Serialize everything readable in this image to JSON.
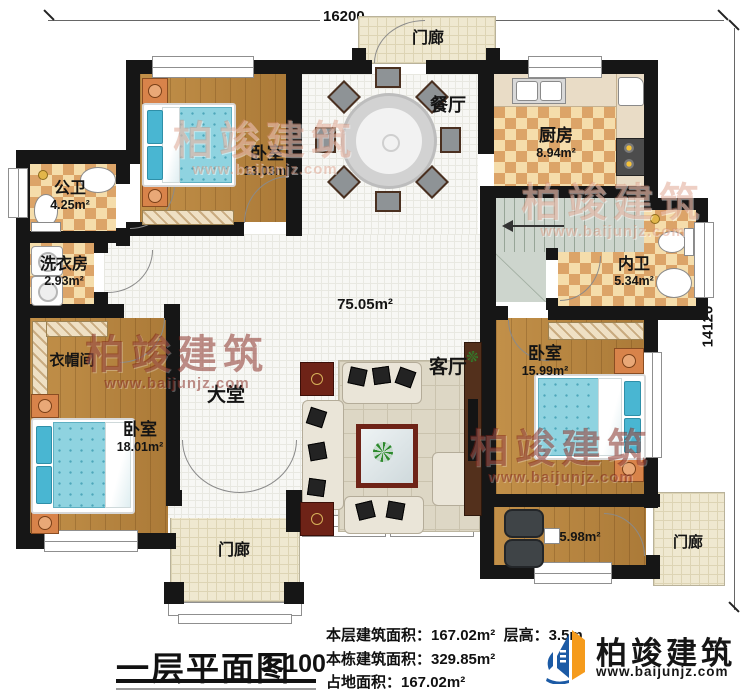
{
  "dimensions": {
    "top": "16200",
    "right": "14120"
  },
  "watermark": {
    "name": "柏竣建筑",
    "site": "www.baijunjz.com"
  },
  "rooms": {
    "porch_top": {
      "label": "门廊"
    },
    "dining": {
      "label": "餐厅"
    },
    "kitchen": {
      "label": "厨房",
      "area": "8.94m²"
    },
    "bedroom_top_left": {
      "label": "卧室",
      "area": "13.03m²"
    },
    "public_bath": {
      "label": "公卫",
      "area": "4.25m²"
    },
    "laundry": {
      "label": "洗衣房",
      "area": "2.93m²"
    },
    "cloakroom": {
      "label": "衣帽间"
    },
    "hall": {
      "label": "大堂",
      "area": "75.05m²"
    },
    "living": {
      "label": "客厅"
    },
    "ensuite_bath": {
      "label": "内卫",
      "area": "5.34m²"
    },
    "bedroom_right": {
      "label": "卧室",
      "area": "15.99m²"
    },
    "bedroom_bottom_left": {
      "label": "卧室",
      "area": "18.01m²"
    },
    "sunroom": {
      "area": "5.98m²"
    },
    "porch_bottom_left": {
      "label": "门廊"
    },
    "porch_bottom_right": {
      "label": "门廊"
    }
  },
  "footer": {
    "title": "一层平面图",
    "scale": "1:100",
    "stats": [
      "本层建筑面积：167.02m²",
      "层高：3.5m",
      "本栋建筑面积：329.85m²",
      "占地面积：167.02m²"
    ]
  },
  "brand": {
    "name": "柏竣建筑",
    "site": "www.baijunjz.com"
  }
}
